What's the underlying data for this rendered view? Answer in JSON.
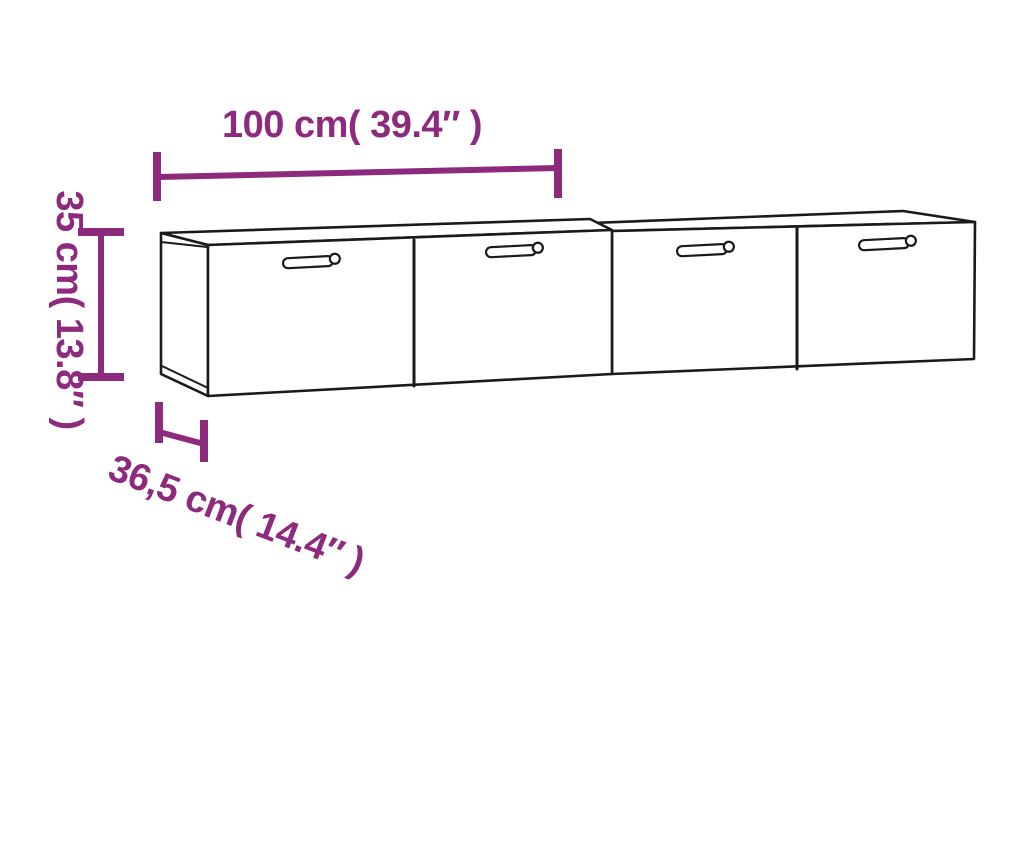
{
  "dimensions": {
    "width": {
      "label": "100 cm( 39.4″ )"
    },
    "height": {
      "label": "35 cm( 13.8″ )"
    },
    "depth": {
      "label": "36,5 cm( 14.4″ )"
    }
  },
  "colors": {
    "dimension_accent": "#8d2a7d",
    "line_art": "#1a1a1a",
    "background": "#ffffff"
  }
}
